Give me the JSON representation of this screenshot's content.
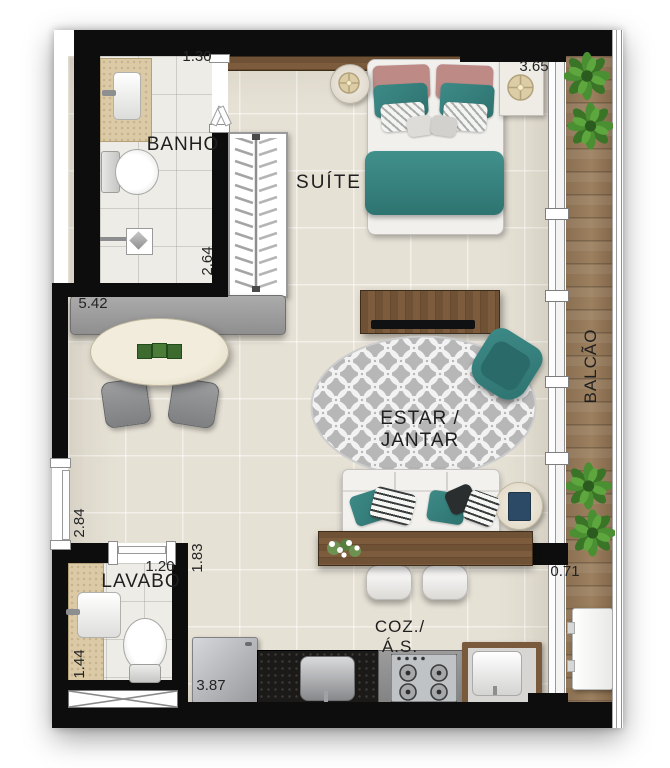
{
  "plan": {
    "type": "apartment-floor-plan",
    "rooms": [
      {
        "id": "banho",
        "label": "BANHO"
      },
      {
        "id": "suite",
        "label": "SUÍTE"
      },
      {
        "id": "balcao",
        "label": "BALCÃO"
      },
      {
        "id": "estar_jantar",
        "label": "ESTAR / JANTAR"
      },
      {
        "id": "lavabo",
        "label": "LAVABO"
      },
      {
        "id": "cozinha_as",
        "label": "COZ./Á.S."
      }
    ],
    "dimensions": [
      {
        "id": "banho-width",
        "value": "1.30"
      },
      {
        "id": "suite-width",
        "value": "3.65"
      },
      {
        "id": "banho-depth",
        "value": "2.64"
      },
      {
        "id": "living-width",
        "value": "5.42"
      },
      {
        "id": "entry-wall",
        "value": "2.84"
      },
      {
        "id": "lavabo-width",
        "value": "1.20"
      },
      {
        "id": "lavabo-depth",
        "value": "1.44"
      },
      {
        "id": "kitchen-wall",
        "value": "1.83"
      },
      {
        "id": "kitchen-width",
        "value": "3.87"
      },
      {
        "id": "balcony-width",
        "value": "0.71"
      }
    ],
    "palette": {
      "wall": "#0d0d0d",
      "floor": "#e6e1d5",
      "wet_floor": "#edece7",
      "wood_deck": "#8e7355",
      "wood_furniture": "#6f5136",
      "accent_teal": "#37817e",
      "accent_rose": "#c08884",
      "rug_gray": "#b7b7b7"
    }
  }
}
